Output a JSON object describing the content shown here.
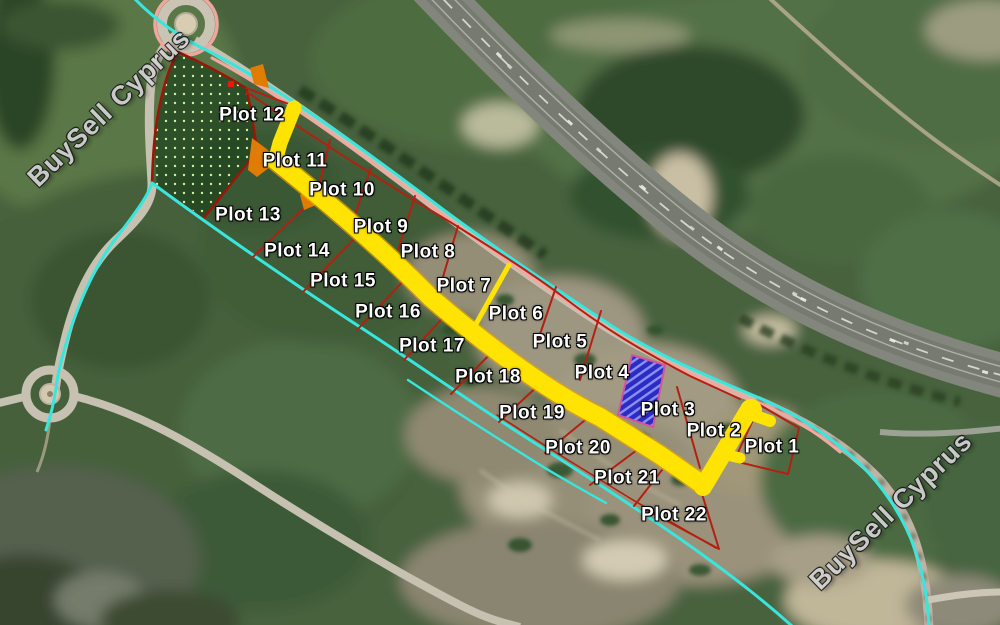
{
  "map": {
    "description": "Aerial photo of 22 land plots for sale beside a highway, with surveyed plot outlines and access road overlay",
    "watermark": {
      "text": "BuySell Cyprus",
      "instances": [
        {
          "x": 109,
          "y": 108,
          "angle": -44
        },
        {
          "x": 891,
          "y": 511,
          "angle": -44
        }
      ]
    },
    "plots": {
      "labels": [
        {
          "text": "Plot 1",
          "x": 772,
          "y": 447
        },
        {
          "text": "Plot 2",
          "x": 714,
          "y": 431
        },
        {
          "text": "Plot 3",
          "x": 668,
          "y": 410
        },
        {
          "text": "Plot 4",
          "x": 602,
          "y": 373
        },
        {
          "text": "Plot 5",
          "x": 560,
          "y": 342
        },
        {
          "text": "Plot 6",
          "x": 516,
          "y": 314
        },
        {
          "text": "Plot 7",
          "x": 464,
          "y": 286
        },
        {
          "text": "Plot 8",
          "x": 428,
          "y": 252
        },
        {
          "text": "Plot 9",
          "x": 381,
          "y": 227
        },
        {
          "text": "Plot 10",
          "x": 342,
          "y": 190
        },
        {
          "text": "Plot 11",
          "x": 295,
          "y": 161
        },
        {
          "text": "Plot 12",
          "x": 252,
          "y": 115
        },
        {
          "text": "Plot 13",
          "x": 248,
          "y": 215
        },
        {
          "text": "Plot 14",
          "x": 297,
          "y": 251
        },
        {
          "text": "Plot 15",
          "x": 343,
          "y": 281
        },
        {
          "text": "Plot 16",
          "x": 388,
          "y": 312
        },
        {
          "text": "Plot 17",
          "x": 432,
          "y": 346
        },
        {
          "text": "Plot 18",
          "x": 488,
          "y": 377
        },
        {
          "text": "Plot 19",
          "x": 532,
          "y": 413
        },
        {
          "text": "Plot 20",
          "x": 578,
          "y": 448
        },
        {
          "text": "Plot 21",
          "x": 627,
          "y": 478
        },
        {
          "text": "Plot 22",
          "x": 674,
          "y": 515
        }
      ]
    },
    "colors": {
      "yellow": "#ffe303",
      "yellowEdge": "#e9a400",
      "cyan": "#38e6de",
      "pink": "#f2a79f",
      "red": "#b32012",
      "hatchBorder": "#9a1606",
      "hatchDot": "#d6eda8",
      "blueFill": "#2323c8",
      "blueStripe": "#8890ff",
      "blueBorder": "#d84f9e",
      "orange": "#e07c00",
      "markerRed": "#ee1705",
      "label": "#ffffff",
      "watermark": "#d2d2d2"
    }
  }
}
